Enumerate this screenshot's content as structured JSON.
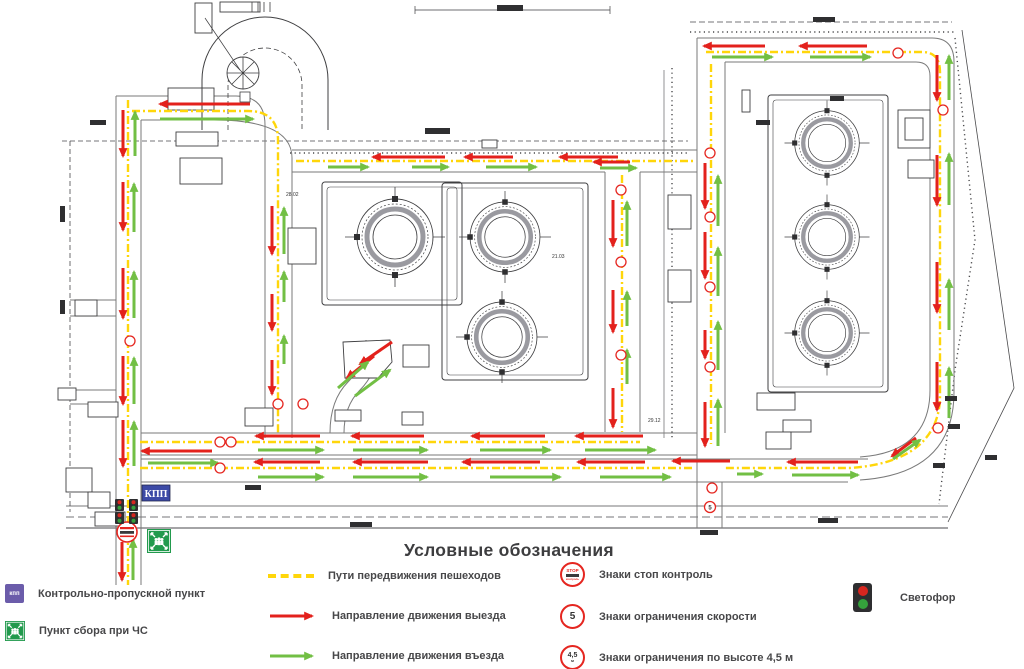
{
  "map": {
    "kpp_box": "КПП",
    "sign5": "5",
    "annotations": [
      "28.02",
      "21.03",
      "29.12"
    ]
  },
  "legend": {
    "title": "Условные обозначения",
    "checkpoint": {
      "badge": "кпп",
      "label": "Контрольно-пропускной пункт"
    },
    "assembly": {
      "label": "Пункт сбора при ЧС"
    },
    "pedestrian": {
      "label": "Пути передвижения пешеходов"
    },
    "exit": {
      "label": "Направление движения выезда"
    },
    "entry": {
      "label": "Направление движения въезда"
    },
    "stop_sign": {
      "top": "STOP",
      "bottom": "контроль",
      "label": "Знаки стоп контроль"
    },
    "speed_sign": {
      "value": "5",
      "label": "Знаки ограничения скорости"
    },
    "height_sign": {
      "value": "4,5",
      "unit": "м",
      "label": "Знаки ограничения по высоте 4,5 м"
    },
    "traffic_light": {
      "label": "Светофор"
    }
  },
  "colors": {
    "exit_arrow": "#e3211c",
    "entry_arrow": "#72bf44",
    "pedestrian_path": "#ffd60a",
    "checkpoint_badge": "#6b5caa",
    "kpp_box": "#3c4aa6",
    "assembly_green": "#229a4d"
  }
}
